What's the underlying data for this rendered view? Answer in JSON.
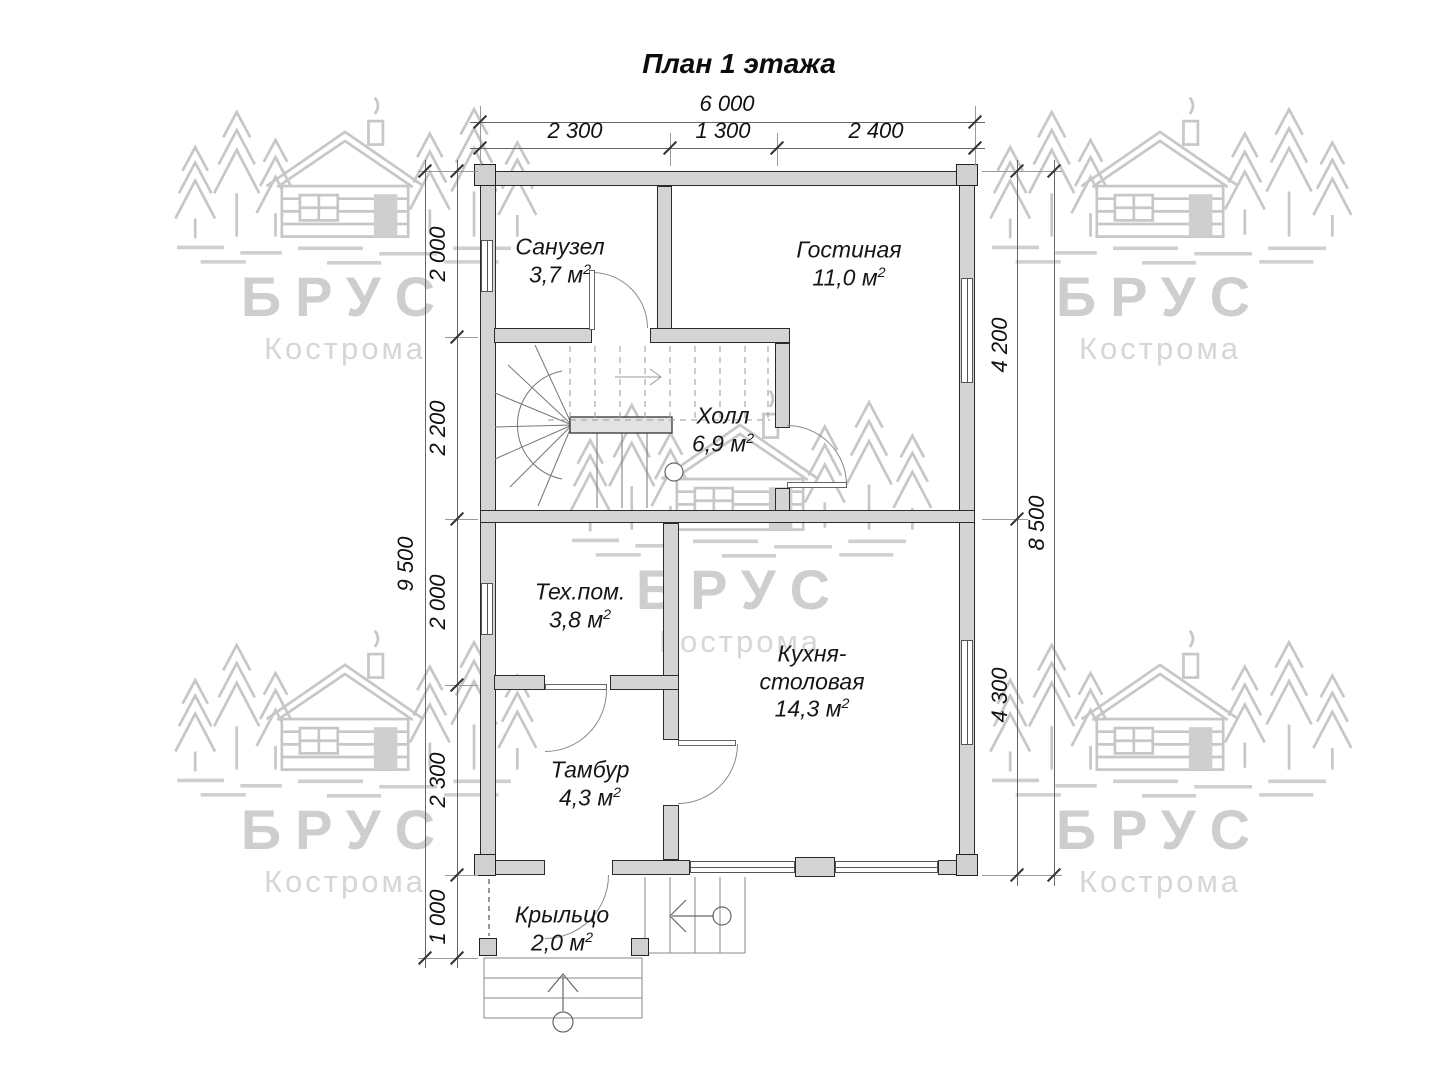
{
  "title": "План 1 этажа",
  "watermark": {
    "brand": "БРУС",
    "city": "Кострома"
  },
  "units": {
    "m": "м",
    "sq": "2"
  },
  "dims": {
    "top_total": "6 000",
    "top_seg": [
      "2 300",
      "1 300",
      "2 400"
    ],
    "left_total": "9 500",
    "left_seg": [
      "2 000",
      "2 200",
      "2 000",
      "2 300",
      "1 000"
    ],
    "right_total": "8 500",
    "right_seg": [
      "4 200",
      "4 300"
    ]
  },
  "rooms": {
    "sanuzel": {
      "name": "Санузел",
      "area": "3,7"
    },
    "gostinaya": {
      "name": "Гостиная",
      "area": "11,0"
    },
    "holl": {
      "name": "Холл",
      "area": "6,9"
    },
    "tehpom": {
      "name": "Тех.пом.",
      "area": "3,8"
    },
    "kuhnya": {
      "line1": "Кухня-",
      "line2": "столовая",
      "area": "14,3"
    },
    "tambur": {
      "name": "Тамбур",
      "area": "4,3"
    },
    "kryltso": {
      "name": "Крыльцо",
      "area": "2,0"
    }
  }
}
